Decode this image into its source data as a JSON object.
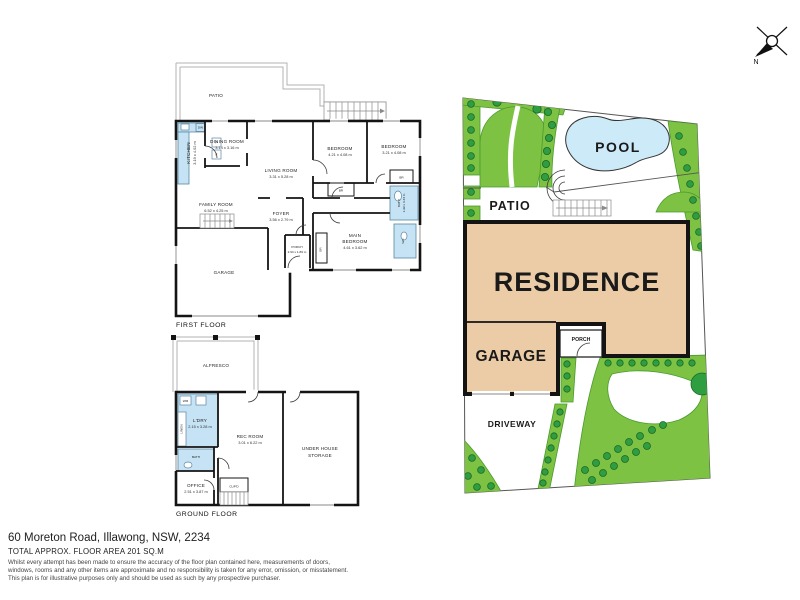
{
  "first_floor": {
    "caption": "FIRST FLOOR",
    "patio": "PATIO",
    "kitchen_name": "KITCHEN",
    "kitchen_dims": "3.19 x 4.02 m",
    "dining_name": "DINING ROOM",
    "dining_dims": "3.14 x 3.16 m",
    "living_name": "LIVING ROOM",
    "living_dims": "3.31 x 5.28 m",
    "family_name": "FAMILY ROOM",
    "family_dims": "6.52 x 4.25 m",
    "bedroom1_name": "BEDROOM",
    "bedroom1_dims": "4.21 x 4.08 m",
    "bedroom2_name": "BEDROOM",
    "bedroom2_dims": "3.21 x 4.08 m",
    "main_bedroom_name1": "MAIN",
    "main_bedroom_name2": "BEDROOM",
    "main_bedroom_dims": "4.61 x 3.62 m",
    "foyer_name": "FOYER",
    "foyer_dims": "3.56 x 2.79 m",
    "porch_name": "PORCH",
    "porch_dims": "2.94 x 1.89 m",
    "garage_name": "GARAGE",
    "bath_name": "BATH",
    "bath_dims": "1.99 x 3.43 m",
    "wc_name": "WC",
    "br": "BR",
    "fixtures": {
      "dw": "DW",
      "p": "P",
      "f": "F"
    }
  },
  "ground_floor": {
    "caption": "GROUND FLOOR",
    "alfresco": "ALFRESCO",
    "laundry_name": "L'DRY",
    "laundry_dims": "2.15 x 3.28 m",
    "wm": "WM",
    "linen": "LINEN",
    "bath": "BATH",
    "office_name": "OFFICE",
    "office_dims": "2.51 x 3.87 m",
    "rec_name": "REC ROOM",
    "rec_dims": "3.01 x 6.22 m",
    "cupd": "CUP'D",
    "storage_name1": "UNDER HOUSE",
    "storage_name2": "STORAGE"
  },
  "site_plan": {
    "residence": "RESIDENCE",
    "garage": "GARAGE",
    "porch": "PORCH",
    "patio": "PATIO",
    "pool": "POOL",
    "driveway": "DRIVEWAY"
  },
  "compass": {
    "north": "N"
  },
  "footer": {
    "address": "60 Moreton Road, Illawong, NSW, 2234",
    "floor_area": "TOTAL APPROX. FLOOR AREA 201 SQ.M",
    "disclaimer": [
      "Whilst every attempt has been made to ensure the accuracy of the floor plan contained here, measurements of doors,",
      "windows, rooms and any other items are approximate and no responsibility is taken for any error, omission, or misstatement.",
      "This plan is for illustrative purposes only and should be used as such by any prospective purchaser."
    ]
  },
  "colors": {
    "grass": "#7dc242",
    "shrub": "#2f9e41",
    "residence_fill": "#eccca6",
    "pool_fill": "#cdeaf8",
    "wet_area": "#c5e3f4",
    "wall": "#141414"
  }
}
